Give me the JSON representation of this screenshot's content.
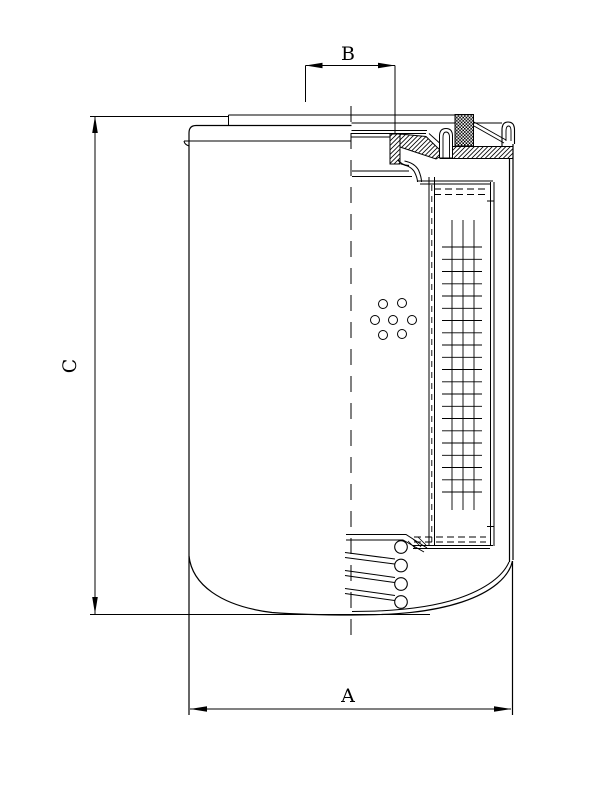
{
  "drawing": {
    "labels": {
      "A": "A",
      "B": "B",
      "C": "C"
    },
    "colors": {
      "background": "#ffffff",
      "line": "#000000"
    }
  }
}
